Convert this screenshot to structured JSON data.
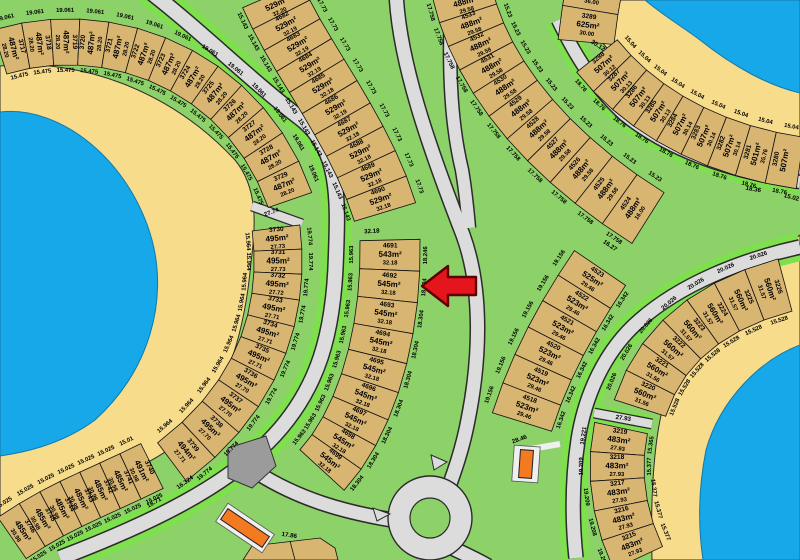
{
  "marker": {
    "type": "left-arrow",
    "target_lot": "4692",
    "color": "#e5151d"
  },
  "groups": [
    {
      "id": "g3717",
      "side_a": "19.061",
      "side_b": "15.475",
      "lots": [
        {
          "n": "3717",
          "a": "487m²",
          "d": "28.20"
        },
        {
          "n": "3718",
          "a": "487m²",
          "d": "28.20"
        },
        {
          "n": "3719",
          "a": "487m²",
          "d": "28.20"
        },
        {
          "n": "3720",
          "a": "487m²",
          "d": "28.20"
        },
        {
          "n": "3721",
          "a": "487m²",
          "d": "28.20"
        },
        {
          "n": "3722",
          "a": "487m²",
          "d": "28.20"
        },
        {
          "n": "3723",
          "a": "487m²",
          "d": "28.20"
        },
        {
          "n": "3724",
          "a": "487m²",
          "d": "28.20"
        },
        {
          "n": "3725",
          "a": "487m²",
          "d": "28.20"
        },
        {
          "n": "3726",
          "a": "487m²",
          "d": "28.20"
        },
        {
          "n": "3727",
          "a": "487m²",
          "d": "28.20"
        },
        {
          "n": "3728",
          "a": "487m²",
          "d": "28.20"
        },
        {
          "n": "3729",
          "a": "487m²",
          "d": "28.20"
        }
      ]
    },
    {
      "id": "g3730",
      "side_a": "19.774",
      "side_b": "15.964",
      "lots": [
        {
          "n": "3730",
          "a": "495m²",
          "d": "27.73"
        },
        {
          "n": "3731",
          "a": "495m²",
          "d": "27.73"
        },
        {
          "n": "3732",
          "a": "495m²",
          "d": "27.72"
        },
        {
          "n": "3733",
          "a": "495m²",
          "d": "27.71"
        },
        {
          "n": "3734",
          "a": "495m²",
          "d": "27.71"
        },
        {
          "n": "3735",
          "a": "495m²",
          "d": "27.71"
        },
        {
          "n": "3736",
          "a": "495m²",
          "d": "27.70"
        },
        {
          "n": "3737",
          "a": "495m²",
          "d": "27.70"
        },
        {
          "n": "3738",
          "a": "495m²",
          "d": "27.70"
        },
        {
          "n": "3739",
          "a": "494m²",
          "d": "27.71"
        }
      ]
    },
    {
      "id": "g3740",
      "side_a": "15.025",
      "side_b_list": [
        "15.01",
        "15.025",
        "15.025",
        "15.025",
        "15.025",
        "15.025",
        "15.025"
      ],
      "lots": [
        {
          "n": "3740",
          "a": "491m²",
          "d": "30.98"
        },
        {
          "n": "3741",
          "a": "485m²",
          "d": "30.98"
        },
        {
          "n": "3742",
          "a": "485m²",
          "d": "30.98"
        },
        {
          "n": "3743",
          "a": "485m²",
          "d": "30.98"
        },
        {
          "n": "3744",
          "a": "485m²",
          "d": "30.98"
        },
        {
          "n": "3745",
          "a": "485m²",
          "d": "30.98"
        },
        {
          "n": "3746",
          "a": "485m²",
          "d": "30.98"
        }
      ]
    },
    {
      "id": "g4681",
      "side_a": "15.143",
      "side_b": "17.73",
      "lots": [
        {
          "n": "",
          "a": "529m²",
          "d": "32.20"
        },
        {
          "n": "4682",
          "a": "529m²",
          "d": "32.19"
        },
        {
          "n": "4683",
          "a": "529m²",
          "d": "32.19"
        },
        {
          "n": "4684",
          "a": "529m²",
          "d": "32.19"
        },
        {
          "n": "4685",
          "a": "529m²",
          "d": "32.18"
        },
        {
          "n": "4686",
          "a": "529m²",
          "d": "32.19"
        },
        {
          "n": "4687",
          "a": "529m²",
          "d": "32.18"
        },
        {
          "n": "4688",
          "a": "529m²",
          "d": "32.18"
        },
        {
          "n": "4689",
          "a": "529m²",
          "d": "32.18"
        },
        {
          "n": "4690",
          "a": "529m²",
          "d": "32.18"
        }
      ]
    },
    {
      "id": "g4691",
      "side_a": "15.963",
      "side_b_list": [
        "18.246",
        "18.304",
        "18.304",
        "18.304",
        "18.304",
        "18.304",
        "18.304",
        "18.304",
        "18.304"
      ],
      "lots": [
        {
          "n": "4691",
          "a": "543m²",
          "d": "32.18"
        },
        {
          "n": "4692",
          "a": "545m²",
          "d": "32.18"
        },
        {
          "n": "4693",
          "a": "545m²",
          "d": "32.18"
        },
        {
          "n": "4694",
          "a": "545m²",
          "d": "32.18"
        },
        {
          "n": "4695",
          "a": "545m²",
          "d": "32.18"
        },
        {
          "n": "4696",
          "a": "545m²",
          "d": "32.18"
        },
        {
          "n": "4697",
          "a": "545m²",
          "d": "32.18"
        },
        {
          "n": "4698",
          "a": "545m²",
          "d": "32.18"
        },
        {
          "n": "4699",
          "a": "545m²",
          "d": "32.18"
        }
      ]
    },
    {
      "id": "g4534",
      "side_a": "17.758",
      "side_b": "15.23",
      "lots": [
        {
          "n": "",
          "a": "488m²",
          "d": "29.58"
        },
        {
          "n": "4533",
          "a": "488m²",
          "d": "29.58"
        },
        {
          "n": "4532",
          "a": "488m²",
          "d": "29.58"
        },
        {
          "n": "4531",
          "a": "488m²",
          "d": "29.58"
        },
        {
          "n": "4530",
          "a": "488m²",
          "d": "29.58"
        },
        {
          "n": "4529",
          "a": "488m²",
          "d": "29.58"
        },
        {
          "n": "4528",
          "a": "488m²",
          "d": "29.58"
        },
        {
          "n": "4527",
          "a": "488m²",
          "d": "29.58"
        },
        {
          "n": "4526",
          "a": "488m²",
          "d": "29.58"
        },
        {
          "n": "4525",
          "a": "488m²",
          "d": "29.58"
        },
        {
          "n": "4524",
          "a": "488m²",
          "d": "16.00"
        }
      ]
    },
    {
      "id": "g4523",
      "side_a": "19.156",
      "side_b": "16.342",
      "lots": [
        {
          "n": "4523",
          "a": "525m²",
          "d": "29.46"
        },
        {
          "n": "4522",
          "a": "523m²",
          "d": "29.46"
        },
        {
          "n": "4521",
          "a": "523m²",
          "d": "29.46"
        },
        {
          "n": "4520",
          "a": "523m²",
          "d": "29.46"
        },
        {
          "n": "4519",
          "a": "523m²",
          "d": "29.46"
        },
        {
          "n": "4518",
          "a": "523m²",
          "d": "29.46"
        }
      ]
    },
    {
      "id": "g3289",
      "side_a": "",
      "side_b": "",
      "lots": [
        {
          "n": "",
          "a": "",
          "d": "36.00"
        },
        {
          "n": "3289",
          "a": "625m²",
          "d": "30.00"
        }
      ]
    },
    {
      "id": "g3288",
      "side_a": "15.04",
      "side_b": "18.76",
      "lots": [
        {
          "n": "3288",
          "a": "507m²",
          "d": "30.12"
        },
        {
          "n": "3287",
          "a": "507m²",
          "d": "30.13"
        },
        {
          "n": "3286",
          "a": "507m²",
          "d": "30.13"
        },
        {
          "n": "3285",
          "a": "507m²",
          "d": "30.13"
        },
        {
          "n": "3284",
          "a": "507m²",
          "d": "30.14"
        },
        {
          "n": "3283",
          "a": "507m²",
          "d": "30.14"
        },
        {
          "n": "3282",
          "a": "507m²",
          "d": "30.14"
        },
        {
          "n": "3281",
          "a": "501m²",
          "d": "35.76"
        },
        {
          "n": "3280",
          "a": "507m²",
          "d": ""
        }
      ]
    },
    {
      "id": "g3220",
      "side_a": "20.026",
      "side_b": "15.528",
      "lots": [
        {
          "n": "3220",
          "a": "560m²",
          "d": "31.56"
        },
        {
          "n": "3221",
          "a": "560m²",
          "d": "31.56"
        },
        {
          "n": "3222",
          "a": "560m²",
          "d": "31.57"
        },
        {
          "n": "3223",
          "a": "560m²",
          "d": "31.57"
        },
        {
          "n": "3224",
          "a": "560m²",
          "d": "31.57"
        },
        {
          "n": "3225",
          "a": "560m²",
          "d": "31.57"
        },
        {
          "n": "3226",
          "a": "560m²",
          "d": "31.57"
        }
      ]
    },
    {
      "id": "g3215",
      "side_a_list": [
        "19.221",
        "19.209",
        "19.209",
        "19.208",
        "19.208"
      ],
      "side_b_list": [
        "15.365",
        "15.377",
        "15.377",
        "15.377",
        "15.377"
      ],
      "lots": [
        {
          "n": "3219",
          "a": "483m²",
          "d": "27.93"
        },
        {
          "n": "3218",
          "a": "483m²",
          "d": "27.93"
        },
        {
          "n": "3217",
          "a": "483m²",
          "d": "27.93"
        },
        {
          "n": "3216",
          "a": "483m²",
          "d": "27.93"
        },
        {
          "n": "3215",
          "a": "483m²",
          "d": "27.93"
        }
      ]
    }
  ],
  "stray_labels": [
    "27.74",
    "32.18",
    "16.27",
    "30.12",
    "28.46",
    "27.93",
    "17.86",
    "18.71",
    "16.324",
    "18.36",
    "15.02"
  ],
  "colors": {
    "land": "#8dd269",
    "verge": "#7fe04e",
    "sand": "#f7dc8c",
    "water": "#16a8e8",
    "road": "#dcdcdc",
    "lot": "#d9b572",
    "marker_red": "#e5151d",
    "utility_orange": "#f47a21"
  }
}
